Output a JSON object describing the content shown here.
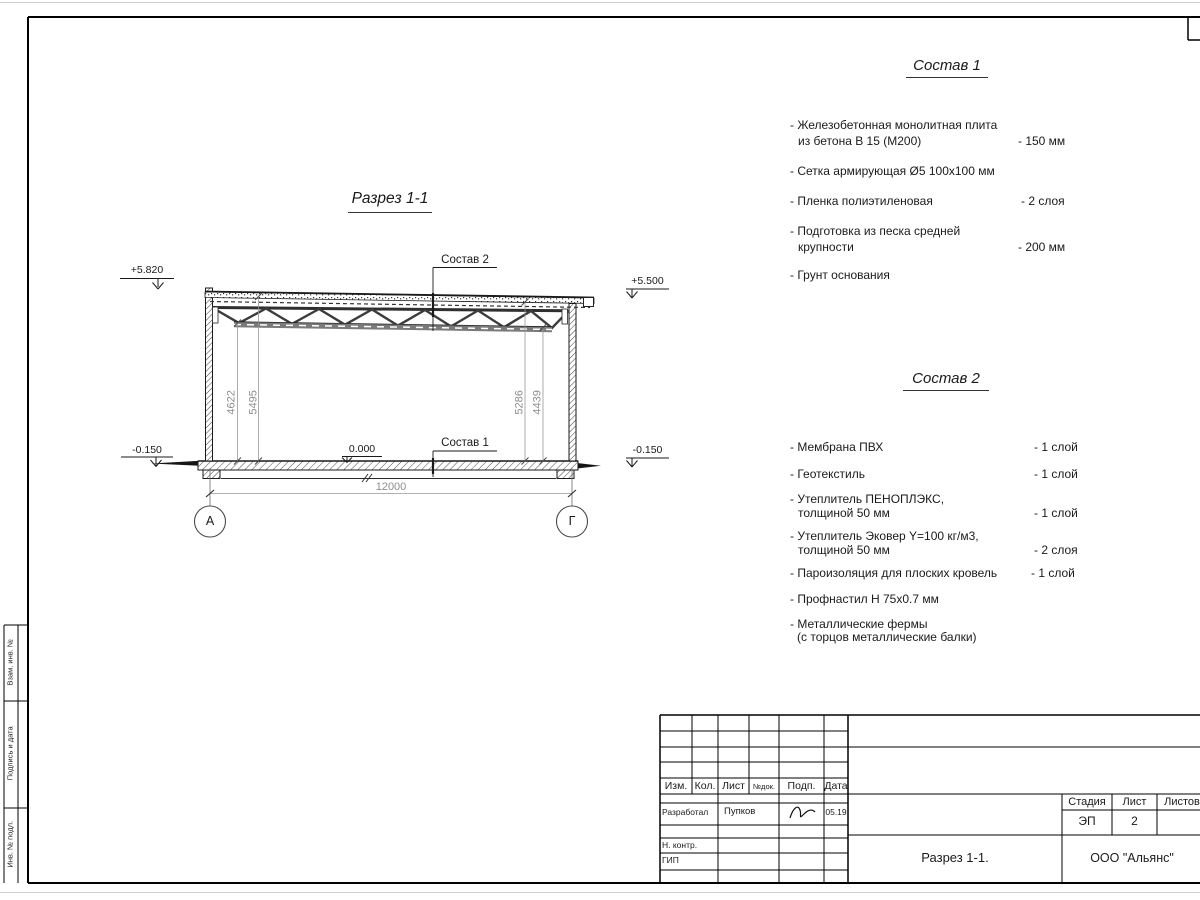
{
  "sheet": {
    "title": "Разрез 1-1",
    "axis_left": "А",
    "axis_right": "Г",
    "elev_top_left": "+5.820",
    "elev_top_right": "+5.500",
    "elev_bottom_left": "-0.150",
    "elev_bottom_right": "-0.150",
    "elev_zero": "0.000",
    "dim_span": "12000",
    "dim_h1": "4622",
    "dim_h2": "5495",
    "dim_h3": "5286",
    "dim_h4": "4439",
    "callout_1": "Состав 1",
    "callout_2": "Состав 2"
  },
  "comp1": {
    "heading": "Состав 1",
    "items": [
      {
        "l1": "- Железобетонная  монолитная плита",
        "l2": "из бетона В 15 (М200)",
        "val": "- 150 мм"
      },
      {
        "l1": "- Сетка армирующая Ø5 100х100 мм",
        "l2": "",
        "val": ""
      },
      {
        "l1": "- Пленка полиэтиленовая",
        "l2": "",
        "val": "-  2 слоя"
      },
      {
        "l1": "- Подготовка из песка средней",
        "l2": "крупности",
        "val": "- 200 мм"
      },
      {
        "l1": "- Грунт основания",
        "l2": "",
        "val": ""
      }
    ]
  },
  "comp2": {
    "heading": "Состав 2",
    "items": [
      {
        "l1": "- Мембрана ПВХ",
        "l2": "",
        "val": "- 1 слой"
      },
      {
        "l1": "- Геотекстиль",
        "l2": "",
        "val": "- 1 слой"
      },
      {
        "l1": "- Утеплитель ПЕНОПЛЭКС,",
        "l2": "толщиной 50 мм",
        "val": "- 1 слой"
      },
      {
        "l1": "- Утеплитель Эковер Y=100 кг/м3,",
        "l2": "толщиной 50 мм",
        "val": "- 2 слоя"
      },
      {
        "l1": "- Пароизоляция для плоских кровель",
        "l2": "",
        "val": "- 1 слой"
      },
      {
        "l1": "- Профнастил Н 75х0.7 мм",
        "l2": "",
        "val": ""
      },
      {
        "l1": "- Металлические фермы",
        "l2": "(с торцов металлические балки)",
        "val": ""
      }
    ]
  },
  "titleblock": {
    "cols": [
      "Изм.",
      "Кол.",
      "Лист",
      "№док.",
      "Подп.",
      "Дата"
    ],
    "developer_role": "Разработал",
    "developer_name": "Пупков",
    "developer_date": "05.19",
    "ncontrol": "Н. контр.",
    "gip": "ГИП",
    "stage_label": "Стадия",
    "sheet_label": "Лист",
    "sheets_label": "Листов",
    "stage_value": "ЭП",
    "sheet_value": "2",
    "doc_title": "Разрез 1-1.",
    "company": "ООО \"Альянс\""
  },
  "margin": {
    "labels": [
      "Взам. инв. №",
      "Подпись и дата",
      "Инв. № подл."
    ]
  }
}
